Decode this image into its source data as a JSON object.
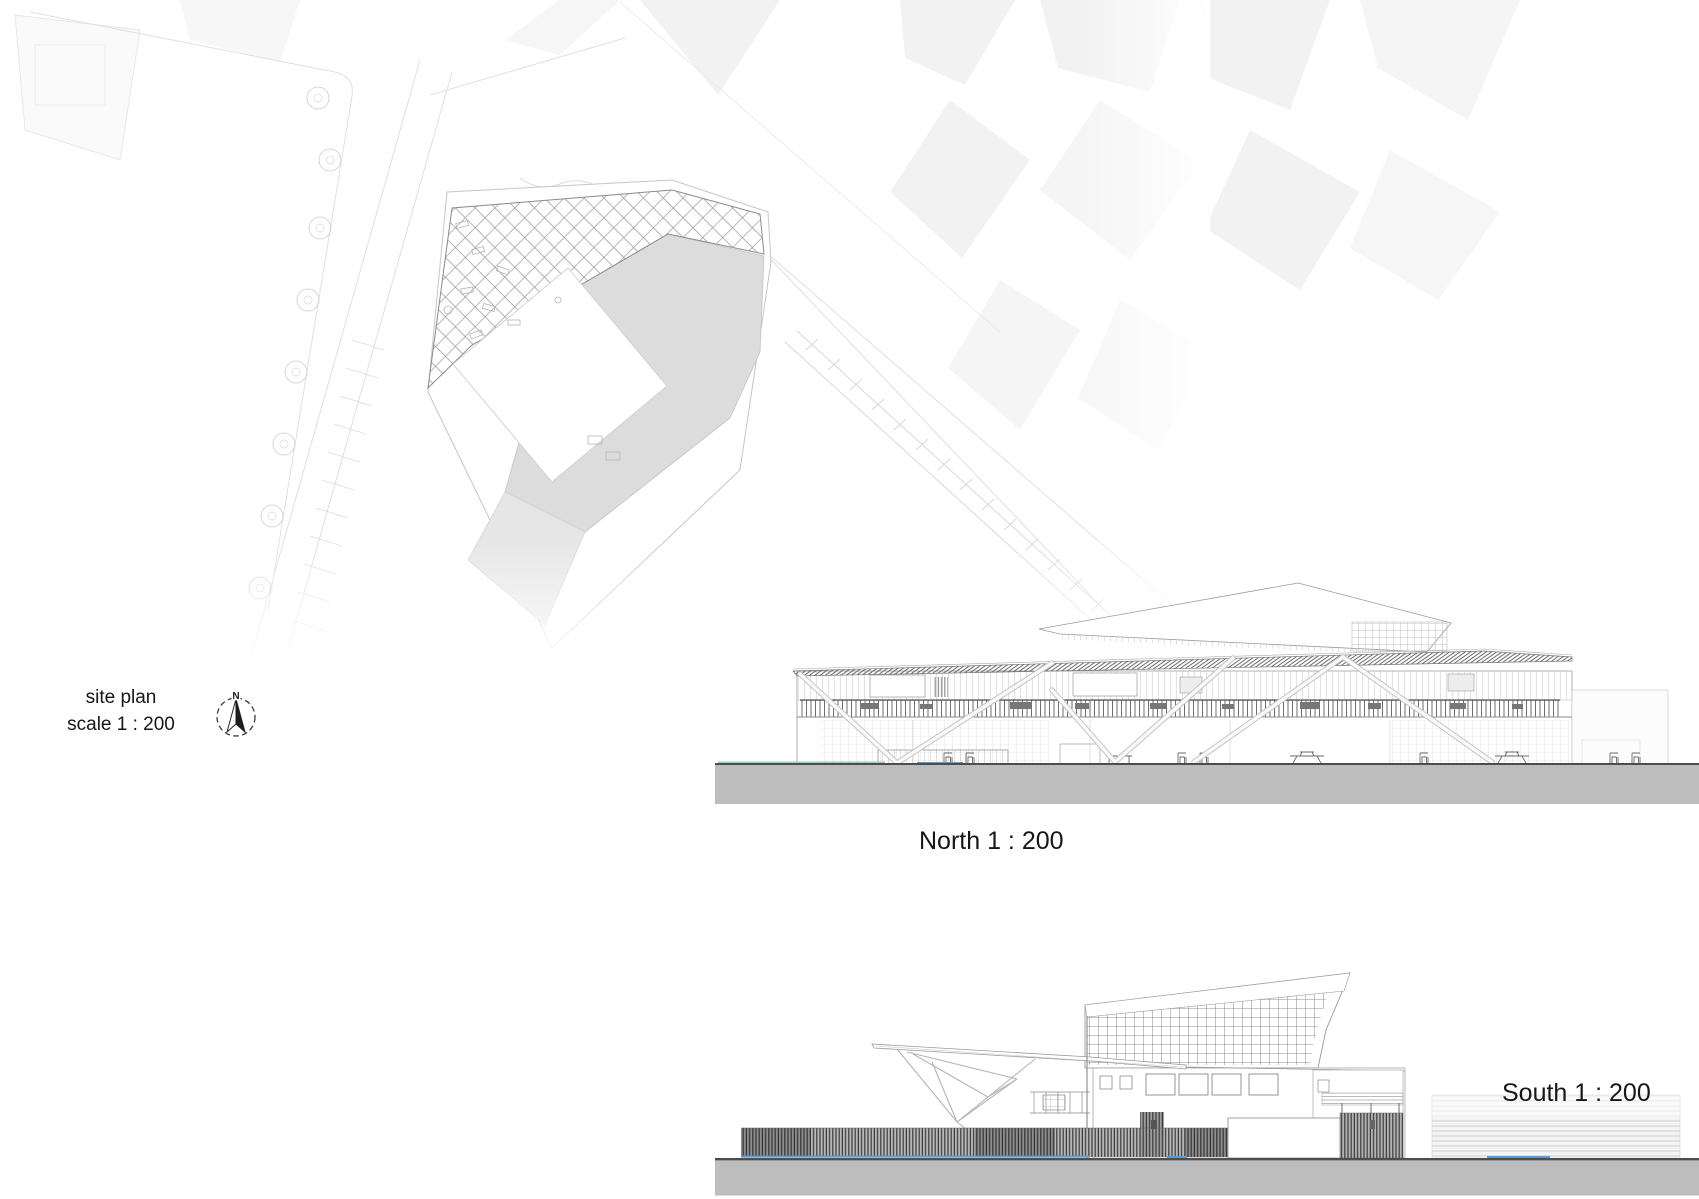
{
  "sheet": {
    "type": "architectural presentation sheet",
    "views": [
      "site plan",
      "north elevation",
      "south elevation"
    ]
  },
  "site_plan_label": {
    "line1": "site plan",
    "line2": "scale 1 : 200"
  },
  "compass": {
    "n_label": "N",
    "icon": "north-arrow-icon"
  },
  "elevation_labels": {
    "north": "North 1 : 200",
    "south": "South 1 : 200"
  },
  "colors": {
    "paper": "#ffffff",
    "ink": "#161616",
    "ground-gray": "#bdbdbd",
    "ground-line": "#4d4d4d",
    "plaza-gray": "#dcdcdc",
    "plaza-light": "#e6e6e6",
    "accent-blue": "#5b9bd5",
    "accent-teal": "#9ccfc4",
    "hatch-line": "#9a9a9a",
    "map-faint": "#f2f2f2",
    "louver-dark": "#3d3d3d"
  }
}
